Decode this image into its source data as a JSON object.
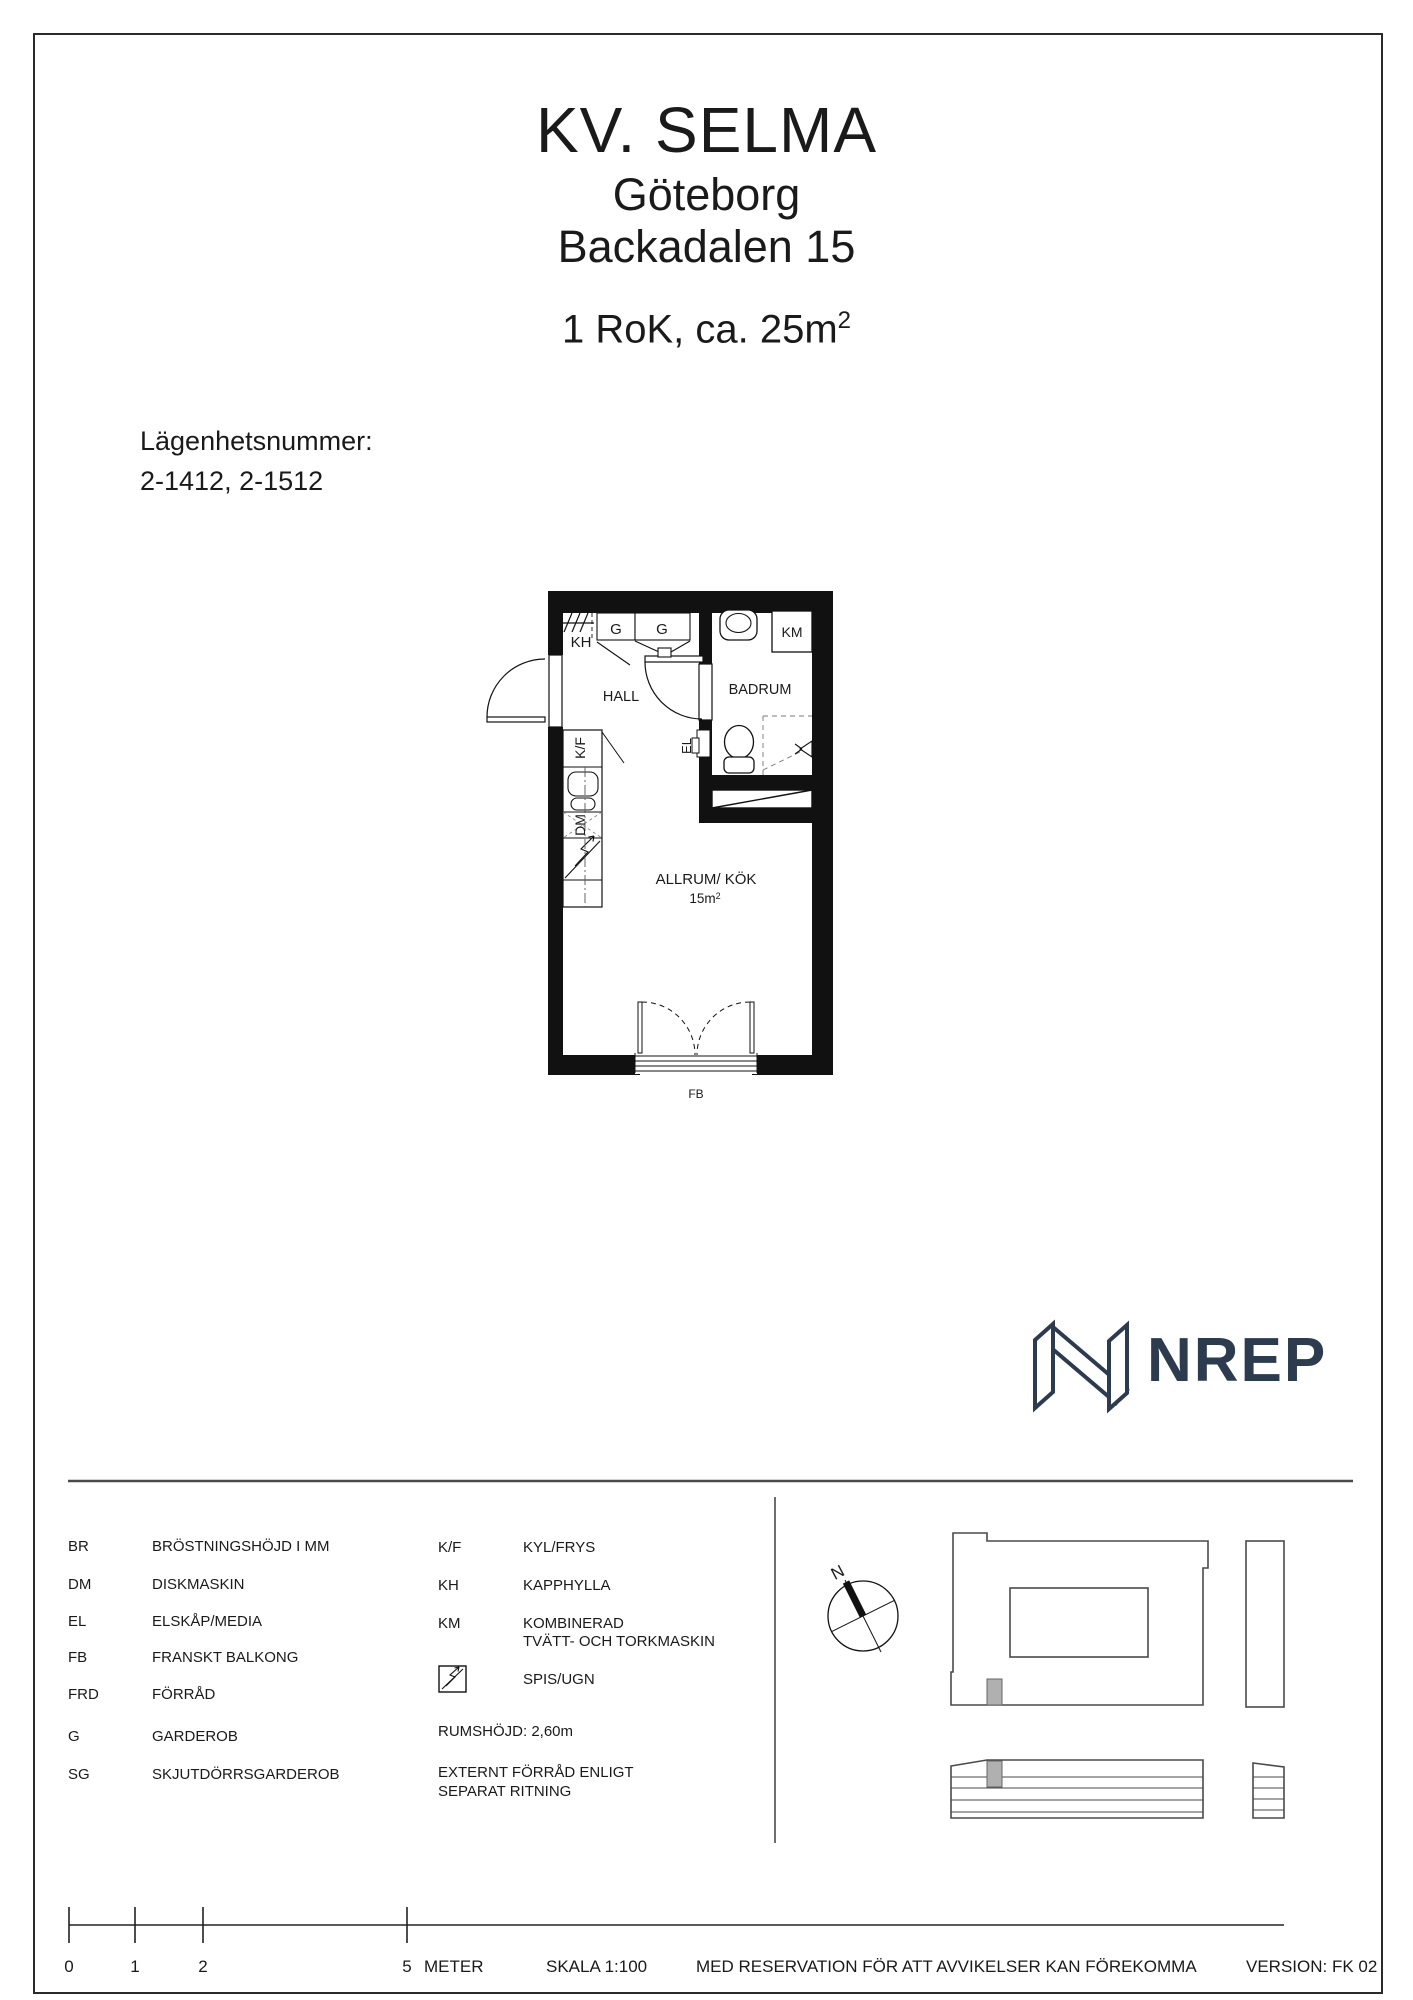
{
  "header": {
    "project": "KV. SELMA",
    "city": "Göteborg",
    "address": "Backadalen 15",
    "subtitle_base": "1 RoK, ca. 25m",
    "subtitle_sup": "2"
  },
  "apartment": {
    "label": "Lägenhetsnummer:",
    "numbers": "2-1412, 2-1512"
  },
  "plan": {
    "hall": "HALL",
    "badrum": "BADRUM",
    "allrum": "ALLRUM/ KÖK",
    "area_base": "15m",
    "area_sup": "2",
    "kh": "KH",
    "g1": "G",
    "g2": "G",
    "km": "KM",
    "kf": "K/F",
    "dm": "DM",
    "el": "EL",
    "fb": "FB"
  },
  "logo": {
    "wordmark": "NREP"
  },
  "legend": {
    "left": [
      {
        "code": "BR",
        "desc": "BRÖSTNINGSHÖJD I MM"
      },
      {
        "code": "DM",
        "desc": "DISKMASKIN"
      },
      {
        "code": "EL",
        "desc": "ELSKÅP/MEDIA"
      },
      {
        "code": "FB",
        "desc": "FRANSKT BALKONG"
      },
      {
        "code": "FRD",
        "desc": "FÖRRÅD"
      },
      {
        "code": "G",
        "desc": "GARDEROB"
      },
      {
        "code": "SG",
        "desc": "SKJUTDÖRRSGARDEROB"
      }
    ],
    "right": [
      {
        "code": "K/F",
        "desc": "KYL/FRYS"
      },
      {
        "code": "KH",
        "desc": "KAPPHYLLA"
      },
      {
        "code": "KM",
        "desc": "KOMBINERAD",
        "desc2": "TVÄTT- OCH TORKMASKIN"
      }
    ],
    "stove_desc": "SPIS/UGN",
    "room_height": "RUMSHÖJD: 2,60m",
    "external_line1": "EXTERNT FÖRRÅD ENLIGT",
    "external_line2": "SEPARAT RITNING"
  },
  "compass": {
    "north": "N"
  },
  "scalebar": {
    "t0": "0",
    "t1": "1",
    "t2": "2",
    "t5": "5",
    "unit": "METER",
    "scale": "SKALA 1:100"
  },
  "footer": {
    "disclaimer": "MED RESERVATION FÖR ATT AVVIKELSER KAN FÖREKOMMA",
    "version": "VERSION: FK 02"
  }
}
